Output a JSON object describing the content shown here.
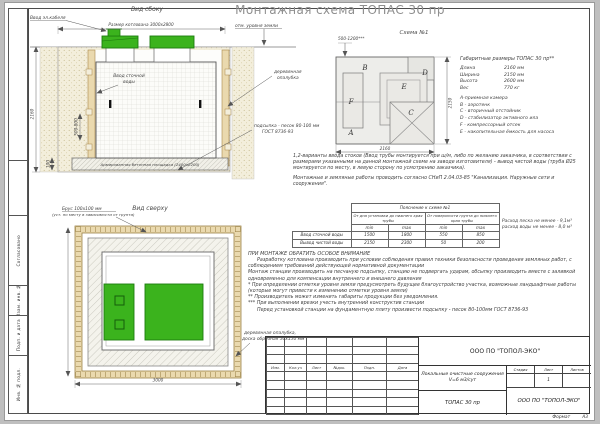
{
  "colors": {
    "green": "#3bb31d",
    "green_dark": "#1d7d0e",
    "timber": "#ead9ae",
    "sand": "#f3eedb"
  },
  "sheet": {
    "title": "Монтажная схема ТОПАС 30 пр",
    "format_label": "Формат",
    "format_value": "А3"
  },
  "stamp_column": {
    "cells": [
      "",
      "",
      "Согласовано",
      "Взам. инв. №",
      "Подп. и дата",
      "Инв. № подл."
    ]
  },
  "side_view": {
    "title": "Вид сбоку",
    "labels": {
      "cable": "Ввод эл.кабеля",
      "pit_size": "Размер котлована 3000х2800",
      "ground": "отм. уровня земли",
      "inlet_line1": "Ввод сточной",
      "inlet_line2": "воды",
      "formwork_line1": "деревянная",
      "formwork_line2": "опалубка",
      "bedding_line1": "подсыпка - песок 80-100 мм",
      "bedding_line2": "ГОСТ 8736-93",
      "slab": "Армированная бетонная площадка (2400х2200)"
    },
    "dims": {
      "depth": "2160",
      "inlet": "500-800",
      "slab_thickness": "100"
    }
  },
  "top_view": {
    "title": "Вид сверху",
    "labels": {
      "timber_line1": "Брус 100х100 мм",
      "timber_line2": "(уст. по месту в зависимости от грунта)",
      "formwork_line1": "деревянная опалубка,",
      "formwork_line2": "доска обрезная 50х150 мм"
    },
    "dims": {
      "width": "3000"
    }
  },
  "scheme": {
    "title": "Схема №1",
    "letters": {
      "a": "A",
      "b": "B",
      "c": "C",
      "d": "D",
      "e": "E",
      "f": "F"
    },
    "dims": {
      "top": "500-1200***",
      "right": "2150",
      "bottom": "2160"
    }
  },
  "specs": {
    "title": "Габаритные размеры ТОПАС 30 пр**",
    "rows": [
      {
        "label": "Длина",
        "value": "2160 мм"
      },
      {
        "label": "Ширина",
        "value": "2150 мм"
      },
      {
        "label": "Высота",
        "value": "2600 мм"
      },
      {
        "label": "Вес",
        "value": "770 кг"
      }
    ],
    "legend": [
      "А-приемная камера",
      "В - аэротенк",
      "С - вторичный отстойник",
      "D - стабилизатор активного ила",
      "F - компрессорный отсек",
      "Е - накопительная ёмкость для насоса"
    ]
  },
  "notes": {
    "variants": "1,2-варианты ввода стоков (Ввод трубы монтируется при ш/м, либо по желанию заказчика, в соответствии с размерами указанными на данной монтажной схеме на заводе изготовителя) - вывод чистой воды (труба Ø25 монтируется по месту, в левую сторону по усмотрению заказчика).",
    "snip": "Монтажные и земляные работы проводить согласно СНиП 2.04.03-85 \"Канализация. Наружные сети и сооружения\".",
    "sand_note_line1": "Расход песка не менее - 9,1м³",
    "sand_note_line2": "расход воды не менее - 8,0 м³"
  },
  "explain_table": {
    "title": "Пояснение к схеме №1",
    "group1": "От дна установки до нижнего края трубы",
    "group2": "От поверхности грунта до нижнего края трубы",
    "sub": [
      "min",
      "max",
      "min",
      "max"
    ],
    "rows": [
      {
        "label": "Ввод сточной воды",
        "v1": "1500",
        "v2": "1800",
        "v3": "550",
        "v4": "850"
      },
      {
        "label": "Вывод чистой воды",
        "v1": "2150",
        "v2": "2300",
        "v3": "50",
        "v4": "200"
      }
    ]
  },
  "attention": {
    "title": "ПРИ МОНТАЖЕ ОБРАТИТЬ ОСОБОЕ ВНИМАНИЕ",
    "lines": [
      "Разработку котлована производить при условии соблюдения правил техники безопасности проведения земляных работ, с соблюдением требований действующей нормативной документации",
      "Монтаж станции производить на песчаную подсыпку, станцию не подвергать ударам, обсыпку производить вместе с заливкой одновременно для компенсации внутреннего и внешнего давления",
      "* При определении отметки уровня земли предусмотреть будущее благоустройство участка, возможные ландшафтные работы (которые могут привести к изменению отметки уровня земли)",
      "** Производитель может изменить габариты продукции без уведомления.",
      "*** При выполнении врезки учесть внутренний конструктив станции",
      "Перед установкой станции на фундаментную плиту произвести подсыпку - песок 80-100мм ГОСТ 8736-93"
    ]
  },
  "title_block": {
    "company_top": "ООО ПО \"ТОПОЛ-ЭКО\"",
    "rev_headers": [
      "Изм.",
      "Кол.уч",
      "Лист",
      "№док.",
      "Подп.",
      "Дата"
    ],
    "doc_title_line1": "Локальные очистные сооружения",
    "doc_title_line2": "V=6 м3/сут",
    "doc_name": "ТОПАС 30 пр",
    "stage_headers": [
      "Стадия",
      "Лист",
      "Листов"
    ],
    "sheet_number": "1",
    "company_bottom": "ООО ПО \"ТОПОЛ-ЭКО\""
  }
}
